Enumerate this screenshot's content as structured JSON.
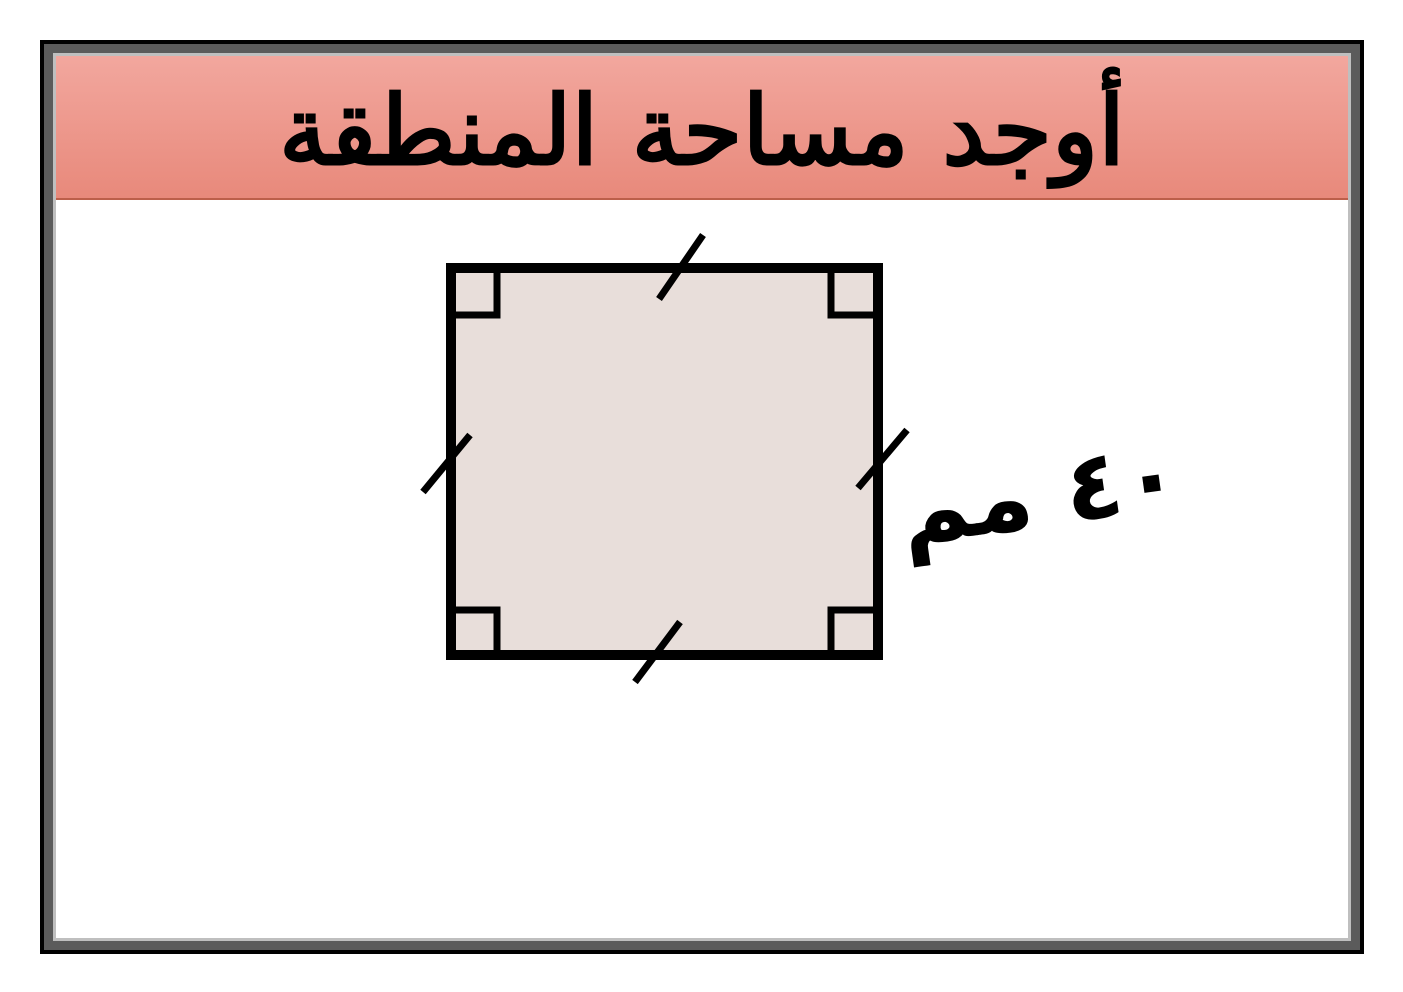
{
  "colors": {
    "page-bg": "#ffffff",
    "frame-outer": "#000000",
    "frame-band": "#5b5b5b",
    "frame-inner-line": "#bfbfbf",
    "header-grad-top": "#f2a79e",
    "header-grad-bottom": "#e8897b",
    "header-underline": "#bc5f4a",
    "square-fill": "#e8deda",
    "shape-stroke": "#000000"
  },
  "header": {
    "title": "أوجد مساحة المنطقة"
  },
  "diagram": {
    "shape": "square",
    "fill": "#e8deda",
    "stroke": "#000000",
    "side_label": "٤٠ مم",
    "side_value": "٤٠",
    "unit": "مم",
    "equal_side_ticks": 4,
    "right_angle_markers": 4
  }
}
